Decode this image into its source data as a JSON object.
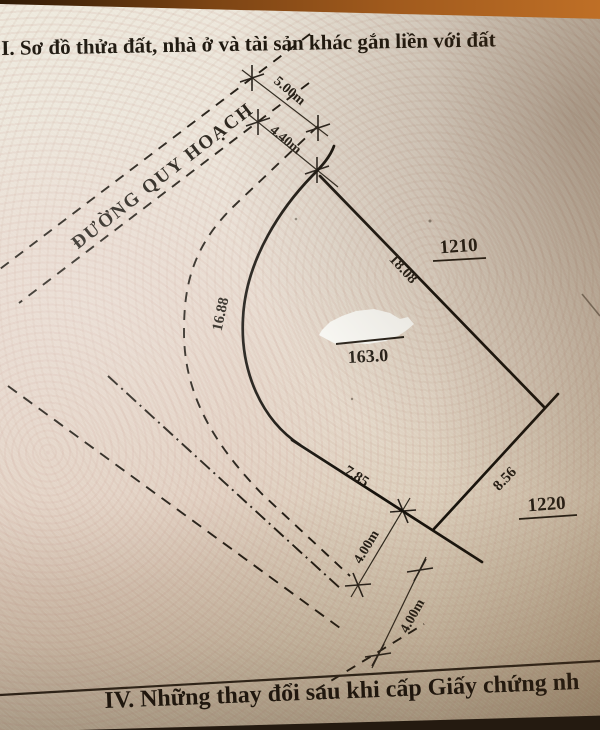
{
  "page": {
    "header": "I. Sơ đồ thửa đất, nhà ở và tài sản khác gắn liền với đất",
    "footer": "IV. Những thay đổi sau khi cấp Giấy chứng nh"
  },
  "diagram": {
    "road_label": "ĐƯỜNG QUY HOẠCH",
    "parcel": {
      "area_label": "163.0",
      "edge_lengths": {
        "right": "18.08",
        "left_curve": "16.88",
        "bottom_left": "7.85",
        "bottom_right": "8.56"
      }
    },
    "adjacent_parcels": {
      "north_east": "1210",
      "south_east": "1220"
    },
    "dimensions": {
      "road_width": "5.00m",
      "setback": "4.40m",
      "lower_road_1": "4.00m",
      "lower_road_2": "4.00m"
    }
  },
  "colors": {
    "paper": "#e7ddd0",
    "ink": "#221c14",
    "table_edge": "#a05a1d",
    "redaction": "#fcfcf8"
  }
}
